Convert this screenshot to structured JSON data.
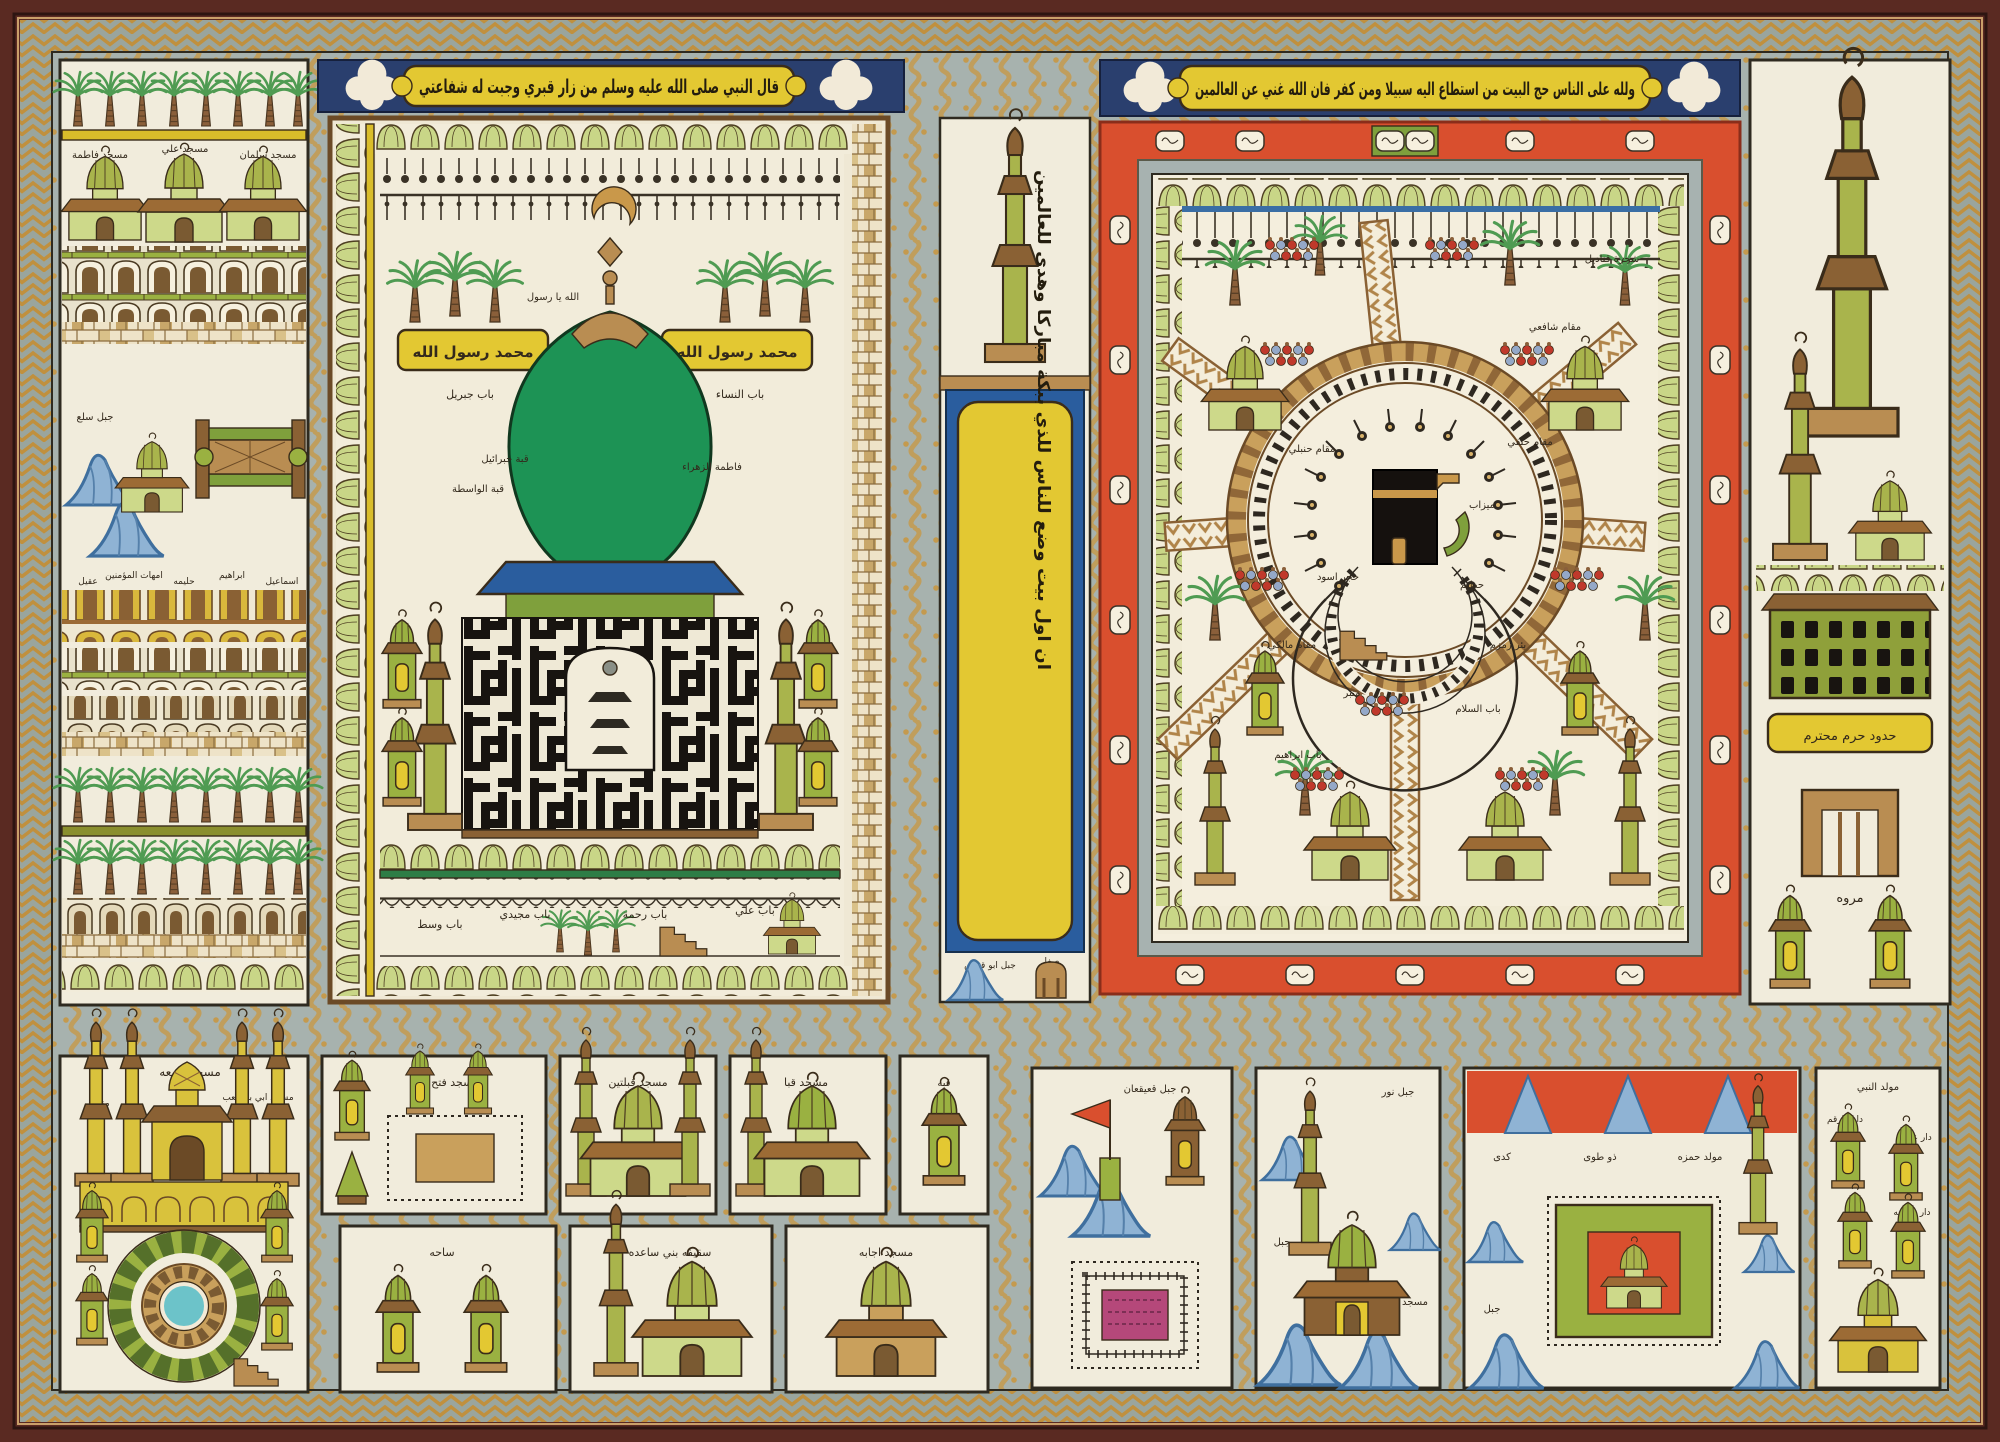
{
  "colors": {
    "frame_maroon": "#5a2a22",
    "border_grey": "#9aa59d",
    "border_gold": "#c0903e",
    "parchment": "#f1ecdc",
    "mecca_red": "#d94f2e",
    "dome_green": "#1d9355",
    "olive_green": "#a9b44c",
    "band_blue": "#2a3f6e",
    "cartouche_yellow": "#e3c832",
    "mountain_blue": "#8fb3d4",
    "kufic_black": "#181410"
  },
  "inscriptions": {
    "medina_hadith": "قال النبي صلى الله عليه وسلم من زار قبري وجبت له شفاعتي",
    "mecca_verse": "ولله على الناس حج البيت من استطاع اليه سبيلا ومن كفر فان الله غني عن العالمين",
    "side_verse": "ان اول بيت وضع للناس للذي ببكة مباركا وهدى للعالمين",
    "kalima_right": "محمد رسول الله",
    "kalima_left": "محمد رسول الله",
    "finial": "الله يا رسول"
  },
  "medina": {
    "labels": {
      "bab_jibril": "باب جبريل",
      "bab_nisa": "باب النساء",
      "qubbat_jibril": "قبة جبرائيل",
      "qubbat_wasita": "قبة الواسطة",
      "fatima": "فاطمة الزهراء",
      "bab_wasat": "باب وسط",
      "bab_majidi": "باب مجيدي",
      "bab_rahma": "باب رحمة",
      "bab_ali": "باب علي"
    }
  },
  "mecca": {
    "labels": {
      "mizab": "ميزاب",
      "hajar": "حجر اسود",
      "hatim": "حطيم",
      "hanbali": "مقام حنبلي",
      "hanafi": "مقام حنفي",
      "maliki": "مقام مالكي",
      "shafii": "مقام شافعي",
      "zamzam": "بئر زمزم",
      "minbar": "منبر",
      "bab_salam": "باب السلام",
      "bab_ibrahim": "باب ابراهيم",
      "q anadil": "",
      "qanadil": "شجرة قناديل",
      "safa": "صفا",
      "marwa": "مروه",
      "jabal_qubais": "جبل ابو قبيس",
      "haram": "حدود حرم محترم"
    }
  },
  "left_column": {
    "mosques": [
      "مسجد فاطمة",
      "مسجد علي",
      "مسجد سلمان"
    ],
    "jabal": "جبل سلع",
    "tombs": [
      "عقيل",
      "امهات المؤمنين",
      "حليمه",
      "ابراهيم",
      "اسماعيل"
    ]
  },
  "bottom": {
    "quba": {
      "title": "مسجد جمعه",
      "right": "مسجد ابي بن كعب",
      "left": "مناره"
    },
    "row1": [
      "مسجد فتح",
      "مسجد قبلتين",
      "مسجد قبا",
      "قبه"
    ],
    "row2": [
      "ساحه",
      "سقيفه بني ساعده",
      "مسجد اجابه"
    ],
    "qaiqian": "جبل قعيقعان",
    "nur": {
      "title": "جبل نور",
      "left": "جبل",
      "right": "مسجد"
    },
    "mina": {
      "a": "كدى",
      "b": "ذو طوى",
      "c": "مولد حمزه",
      "d": "جبل"
    },
    "mawlid": {
      "a": "مولد النبي",
      "b": "دار الارقم",
      "c": "دار عباس",
      "d": "دار خديجه"
    }
  }
}
